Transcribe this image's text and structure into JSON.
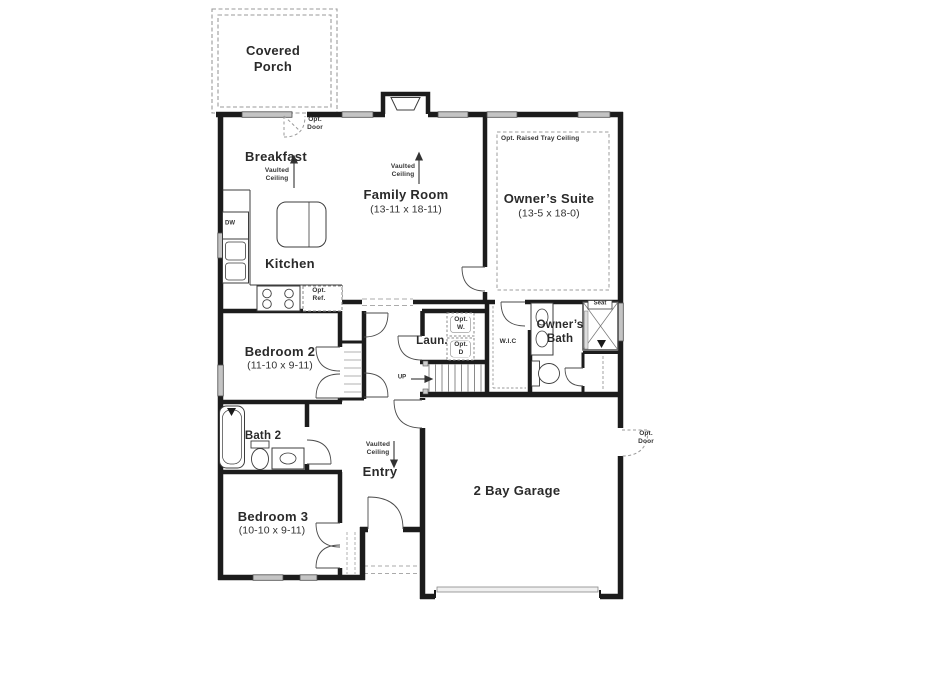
{
  "plan": {
    "title": "Single-story floor plan",
    "colors": {
      "wall": "#1c1c1c",
      "window_fill": "#c4c4c4",
      "dash_gray": "#9a9a9a",
      "text": "#2a2a2a",
      "background": "#ffffff"
    },
    "rooms": {
      "covered_porch": {
        "name": "Covered\nPorch"
      },
      "breakfast": {
        "name": "Breakfast"
      },
      "family_room": {
        "name": "Family Room",
        "dims": "(13-11 x 18-11)"
      },
      "owners_suite": {
        "name": "Owner’s Suite",
        "dims": "(13-5 x 18-0)"
      },
      "kitchen": {
        "name": "Kitchen"
      },
      "bedroom_2": {
        "name": "Bedroom 2",
        "dims": "(11-10 x 9-11)"
      },
      "bedroom_3": {
        "name": "Bedroom 3",
        "dims": "(10-10 x 9-11)"
      },
      "bath_2": {
        "name": "Bath 2"
      },
      "laundry": {
        "name": "Laun."
      },
      "walk_in_closet": {
        "name": "W.I.C"
      },
      "owners_bath": {
        "name": "Owner’s\nBath"
      },
      "entry": {
        "name": "Entry"
      },
      "garage": {
        "name": "2 Bay Garage"
      }
    },
    "annotations": {
      "vaulted_ceiling": "Vaulted\nCeiling",
      "tray_ceiling": "Opt. Raised Tray Ceiling",
      "opt_door": "Opt.\nDoor",
      "opt_ref": "Opt.\nRef.",
      "opt_washer": "Opt.\nW.",
      "opt_dryer": "Opt.\nD",
      "dishwasher": "DW",
      "seat": "Seat",
      "up": "UP"
    }
  }
}
